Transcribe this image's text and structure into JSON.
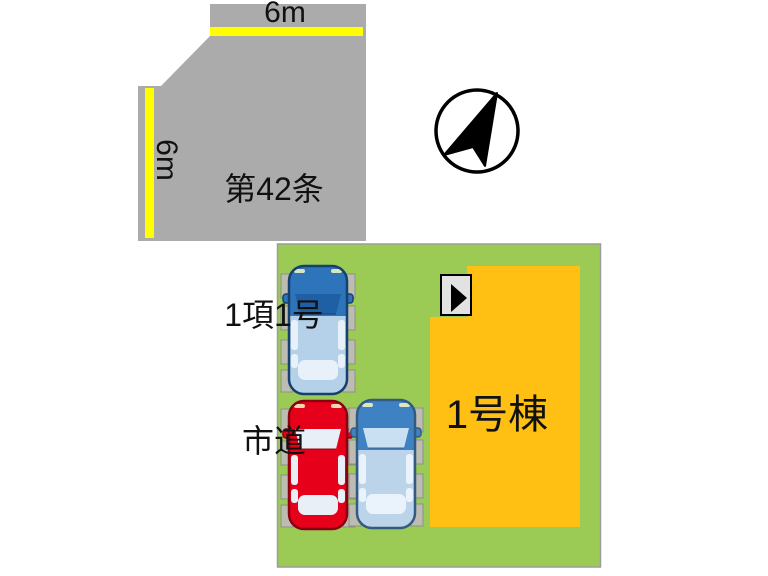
{
  "road": {
    "name_line1": "第42条",
    "name_line2": "1項1号",
    "name_line3": "市道",
    "top_width_label": "6m",
    "left_width_label": "6m"
  },
  "lot": {
    "building_label": "1号棟"
  },
  "cars": [
    {
      "color_name": "blue",
      "body_hex": "#2e74ba",
      "position": "upper-left"
    },
    {
      "color_name": "red",
      "body_hex": "#e70019",
      "position": "lower-left"
    },
    {
      "color_name": "blue",
      "body_hex": "#3f82c4",
      "position": "lower-middle"
    }
  ],
  "icons": {
    "north_arrow": "north-arrow-compass",
    "entrance_marker": "right-pointing-triangle"
  },
  "colors": {
    "road": "#ababab",
    "road_line": "#ffff00",
    "lot": "#9bcb55",
    "lot_border": "#9c9c9c",
    "building": "#ffc013",
    "entrance_box": "#e2e2e2"
  }
}
